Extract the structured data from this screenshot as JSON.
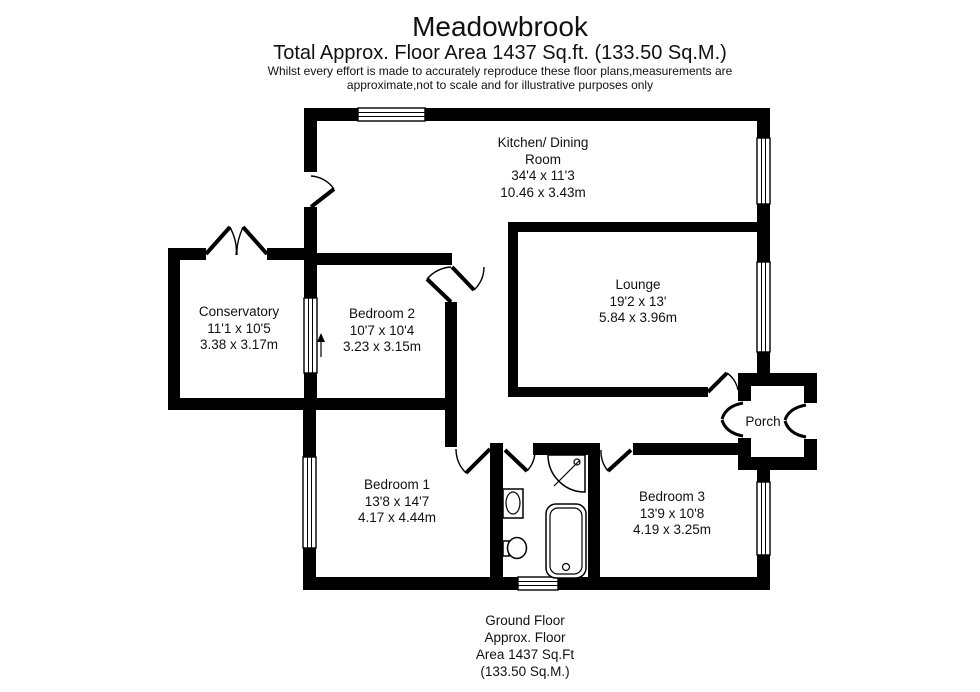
{
  "header": {
    "title": "Meadowbrook",
    "subtitle": "Total Approx. Floor Area 1437 Sq.ft. (133.50 Sq.M.)",
    "disclaimer_line1": "Whilst every effort is made to accurately reproduce these floor plans,measurements are",
    "disclaimer_line2": "approximate,not to scale and for illustrative purposes only"
  },
  "rooms": {
    "kitchen_dining": {
      "lines": [
        "Kitchen/ Dining",
        "Room",
        "34'4 x 11'3",
        "10.46 x 3.43m"
      ]
    },
    "lounge": {
      "lines": [
        "Lounge",
        "19'2 x 13'",
        "5.84 x 3.96m"
      ]
    },
    "conservatory": {
      "lines": [
        "Conservatory",
        "11'1 x 10'5",
        "3.38 x 3.17m"
      ]
    },
    "bedroom_2": {
      "lines": [
        "Bedroom 2",
        "10'7 x 10'4",
        "3.23 x 3.15m"
      ]
    },
    "bedroom_1": {
      "lines": [
        "Bedroom 1",
        "13'8 x 14'7",
        "4.17 x 4.44m"
      ]
    },
    "bedroom_3": {
      "lines": [
        "Bedroom 3",
        "13'9 x 10'8",
        "4.19 x 3.25m"
      ]
    },
    "porch": {
      "lines": [
        "Porch"
      ]
    }
  },
  "footer": {
    "lines": [
      "Ground Floor",
      "Approx. Floor",
      "Area 1437 Sq.Ft",
      "(133.50 Sq.M.)"
    ]
  },
  "colors": {
    "wall": "#000000",
    "background": "#ffffff",
    "text": "#111111"
  }
}
